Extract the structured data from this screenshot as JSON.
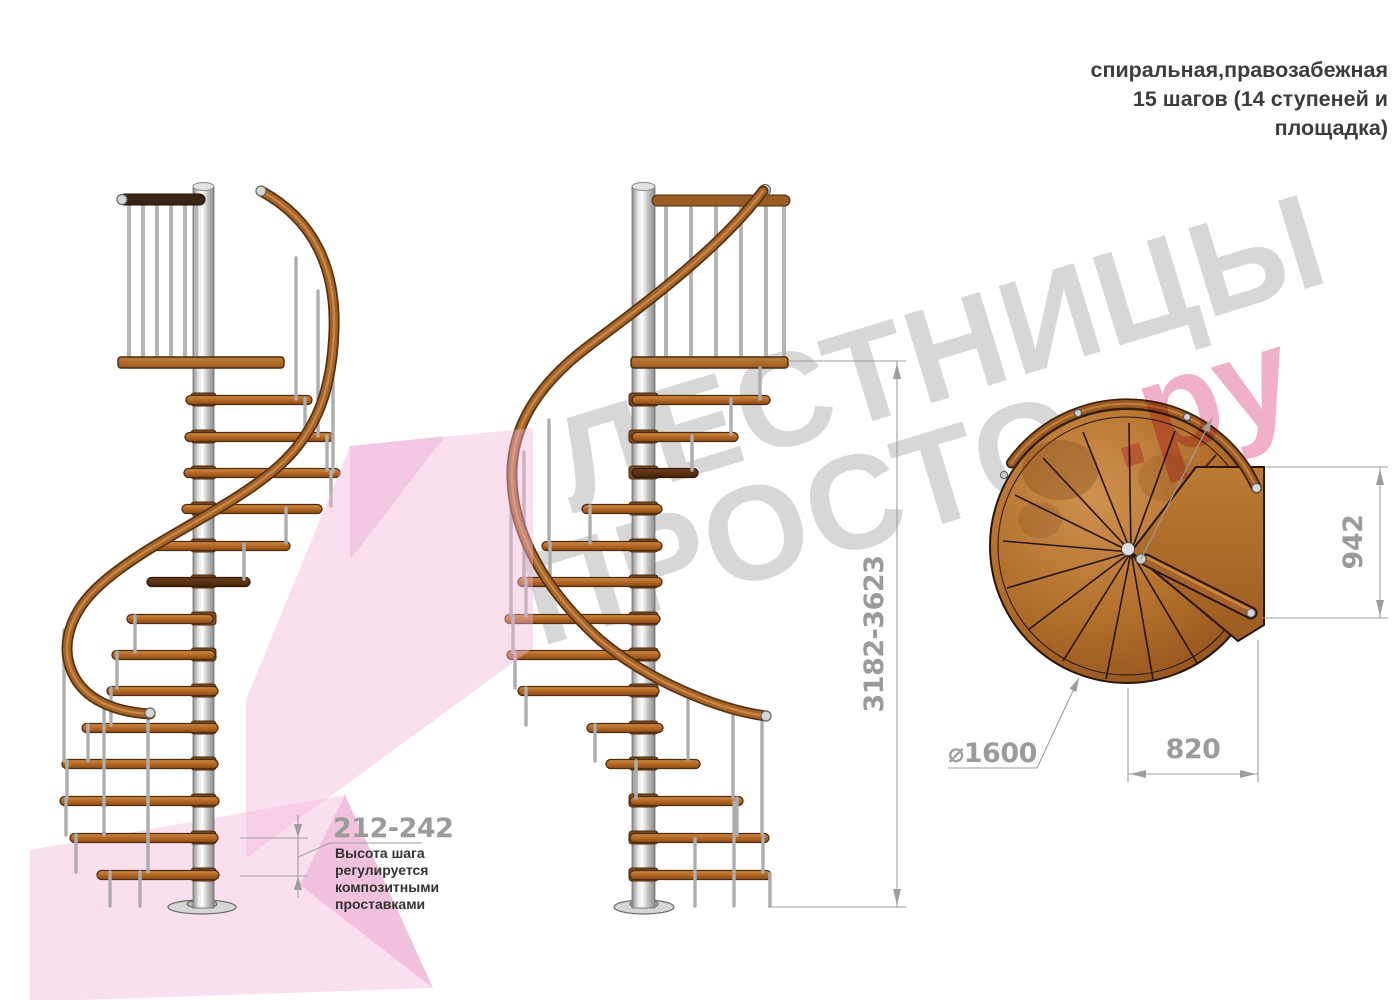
{
  "title": {
    "line1": "спиральная,правозабежная",
    "line2": "15 шагов (14 ступеней и",
    "line3": "площадка)"
  },
  "watermark": {
    "word1": "ЛЕСТНИЦЫ",
    "word2": "ПРОСТО",
    "suffix": ".ру"
  },
  "dimensions": {
    "overall_height": "3182-3623",
    "landing_length": "942",
    "landing_width": "820",
    "diameter": "⌀1600",
    "step_rise": "212-242"
  },
  "note": {
    "line1": "Высота шага",
    "line2": "регулируется",
    "line3": "композитными",
    "line4": "проставками"
  },
  "colors": {
    "wood": "#a5632a",
    "metal": "#c9c9c9",
    "watermark_gray": "#d7d7d7",
    "watermark_pink": "#f0a8c4",
    "pink_ribbon": "#f2b4d8",
    "dimension_gray": "#9b9b9b",
    "header_text": "#3d3d3d"
  }
}
